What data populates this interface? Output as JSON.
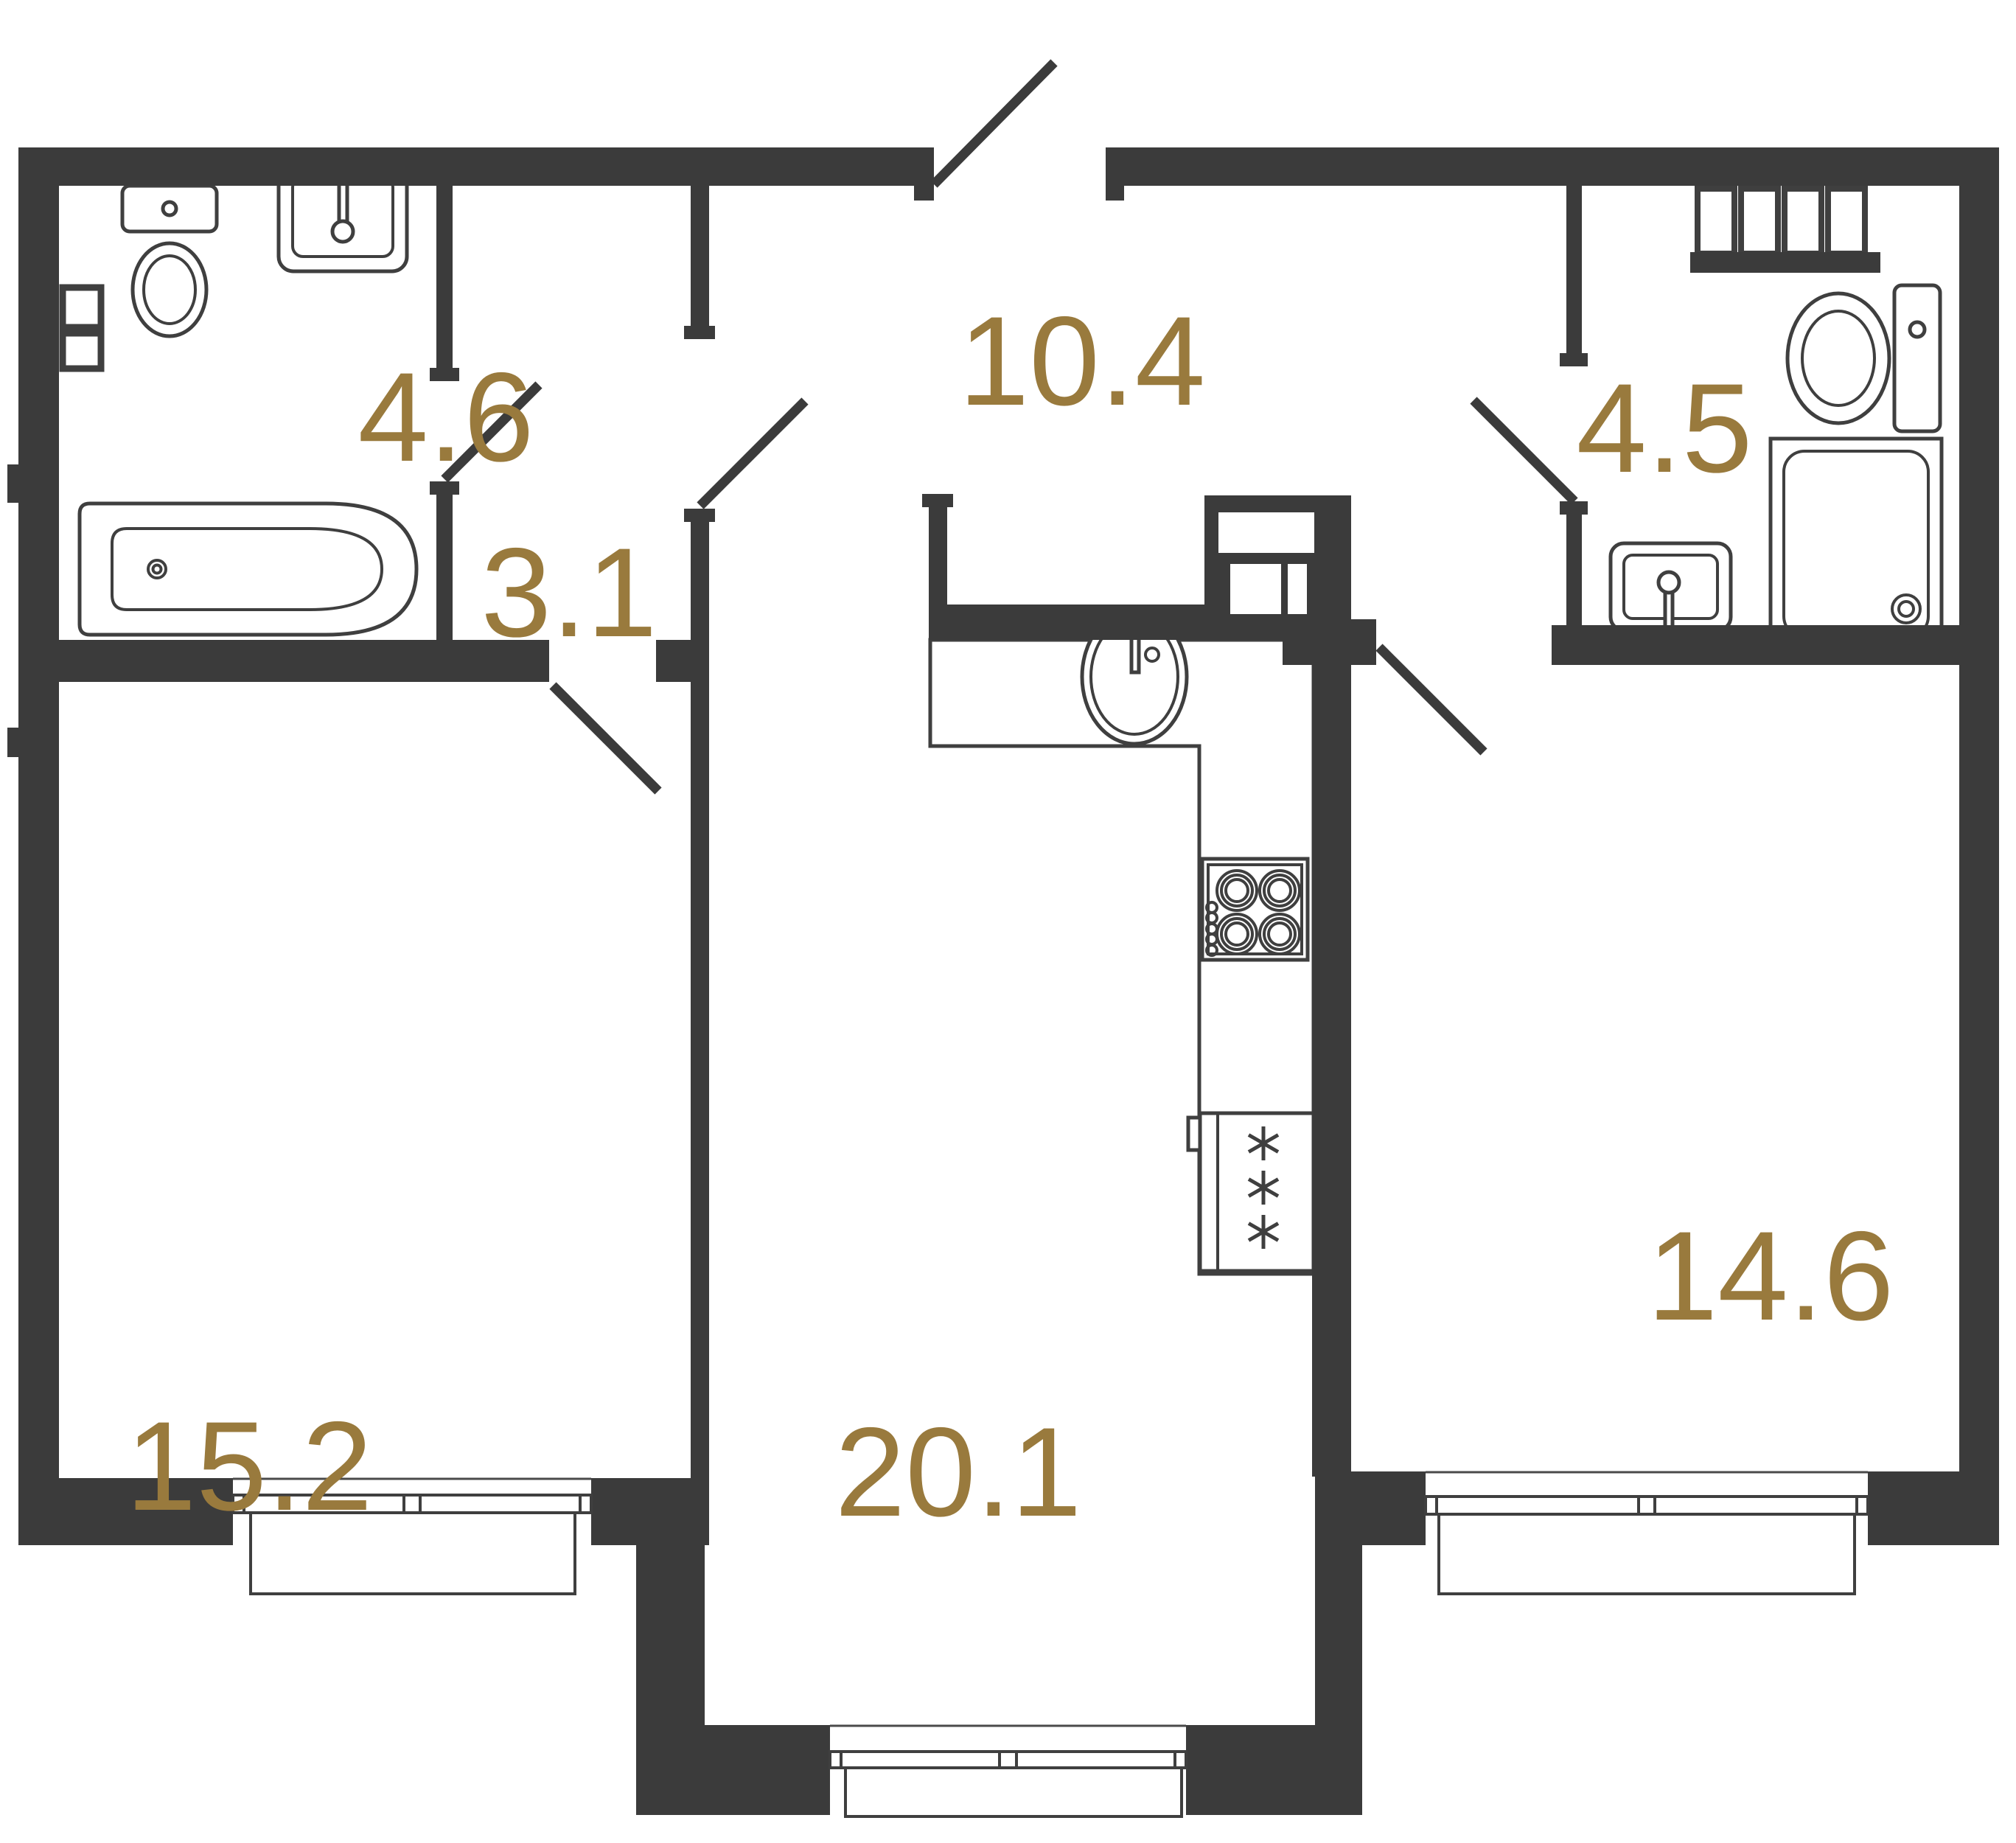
{
  "title": "Apartment floor plan",
  "colors": {
    "wall": "#3b3b3b",
    "label": "#997a3d",
    "fixture_line": "#3f3f3f",
    "background": "#ffffff"
  },
  "rooms": [
    {
      "name": "bathroom",
      "area": "4.6"
    },
    {
      "name": "hall",
      "area": "3.1"
    },
    {
      "name": "corridor",
      "area": "10.4"
    },
    {
      "name": "shower-room",
      "area": "4.5"
    },
    {
      "name": "room",
      "area": "15.2"
    },
    {
      "name": "kitchen-living-room",
      "area": "20.1"
    },
    {
      "name": "bedroom",
      "area": "14.6"
    }
  ],
  "fixtures": [
    "toilet",
    "wall-sink",
    "bathtub",
    "wall-boxes",
    "towel-radiator",
    "toilet-2",
    "sink-2",
    "shower-tray",
    "kitchen-sink",
    "cooktop",
    "fridge",
    "ventilation-duct",
    "kitchen-counter"
  ],
  "doors": [
    "entrance-door",
    "bathroom-door",
    "hall-door",
    "room-door",
    "bedroom-door",
    "shower-room-door"
  ],
  "windows": [
    "room-window",
    "kitchen-window",
    "bedroom-window"
  ]
}
